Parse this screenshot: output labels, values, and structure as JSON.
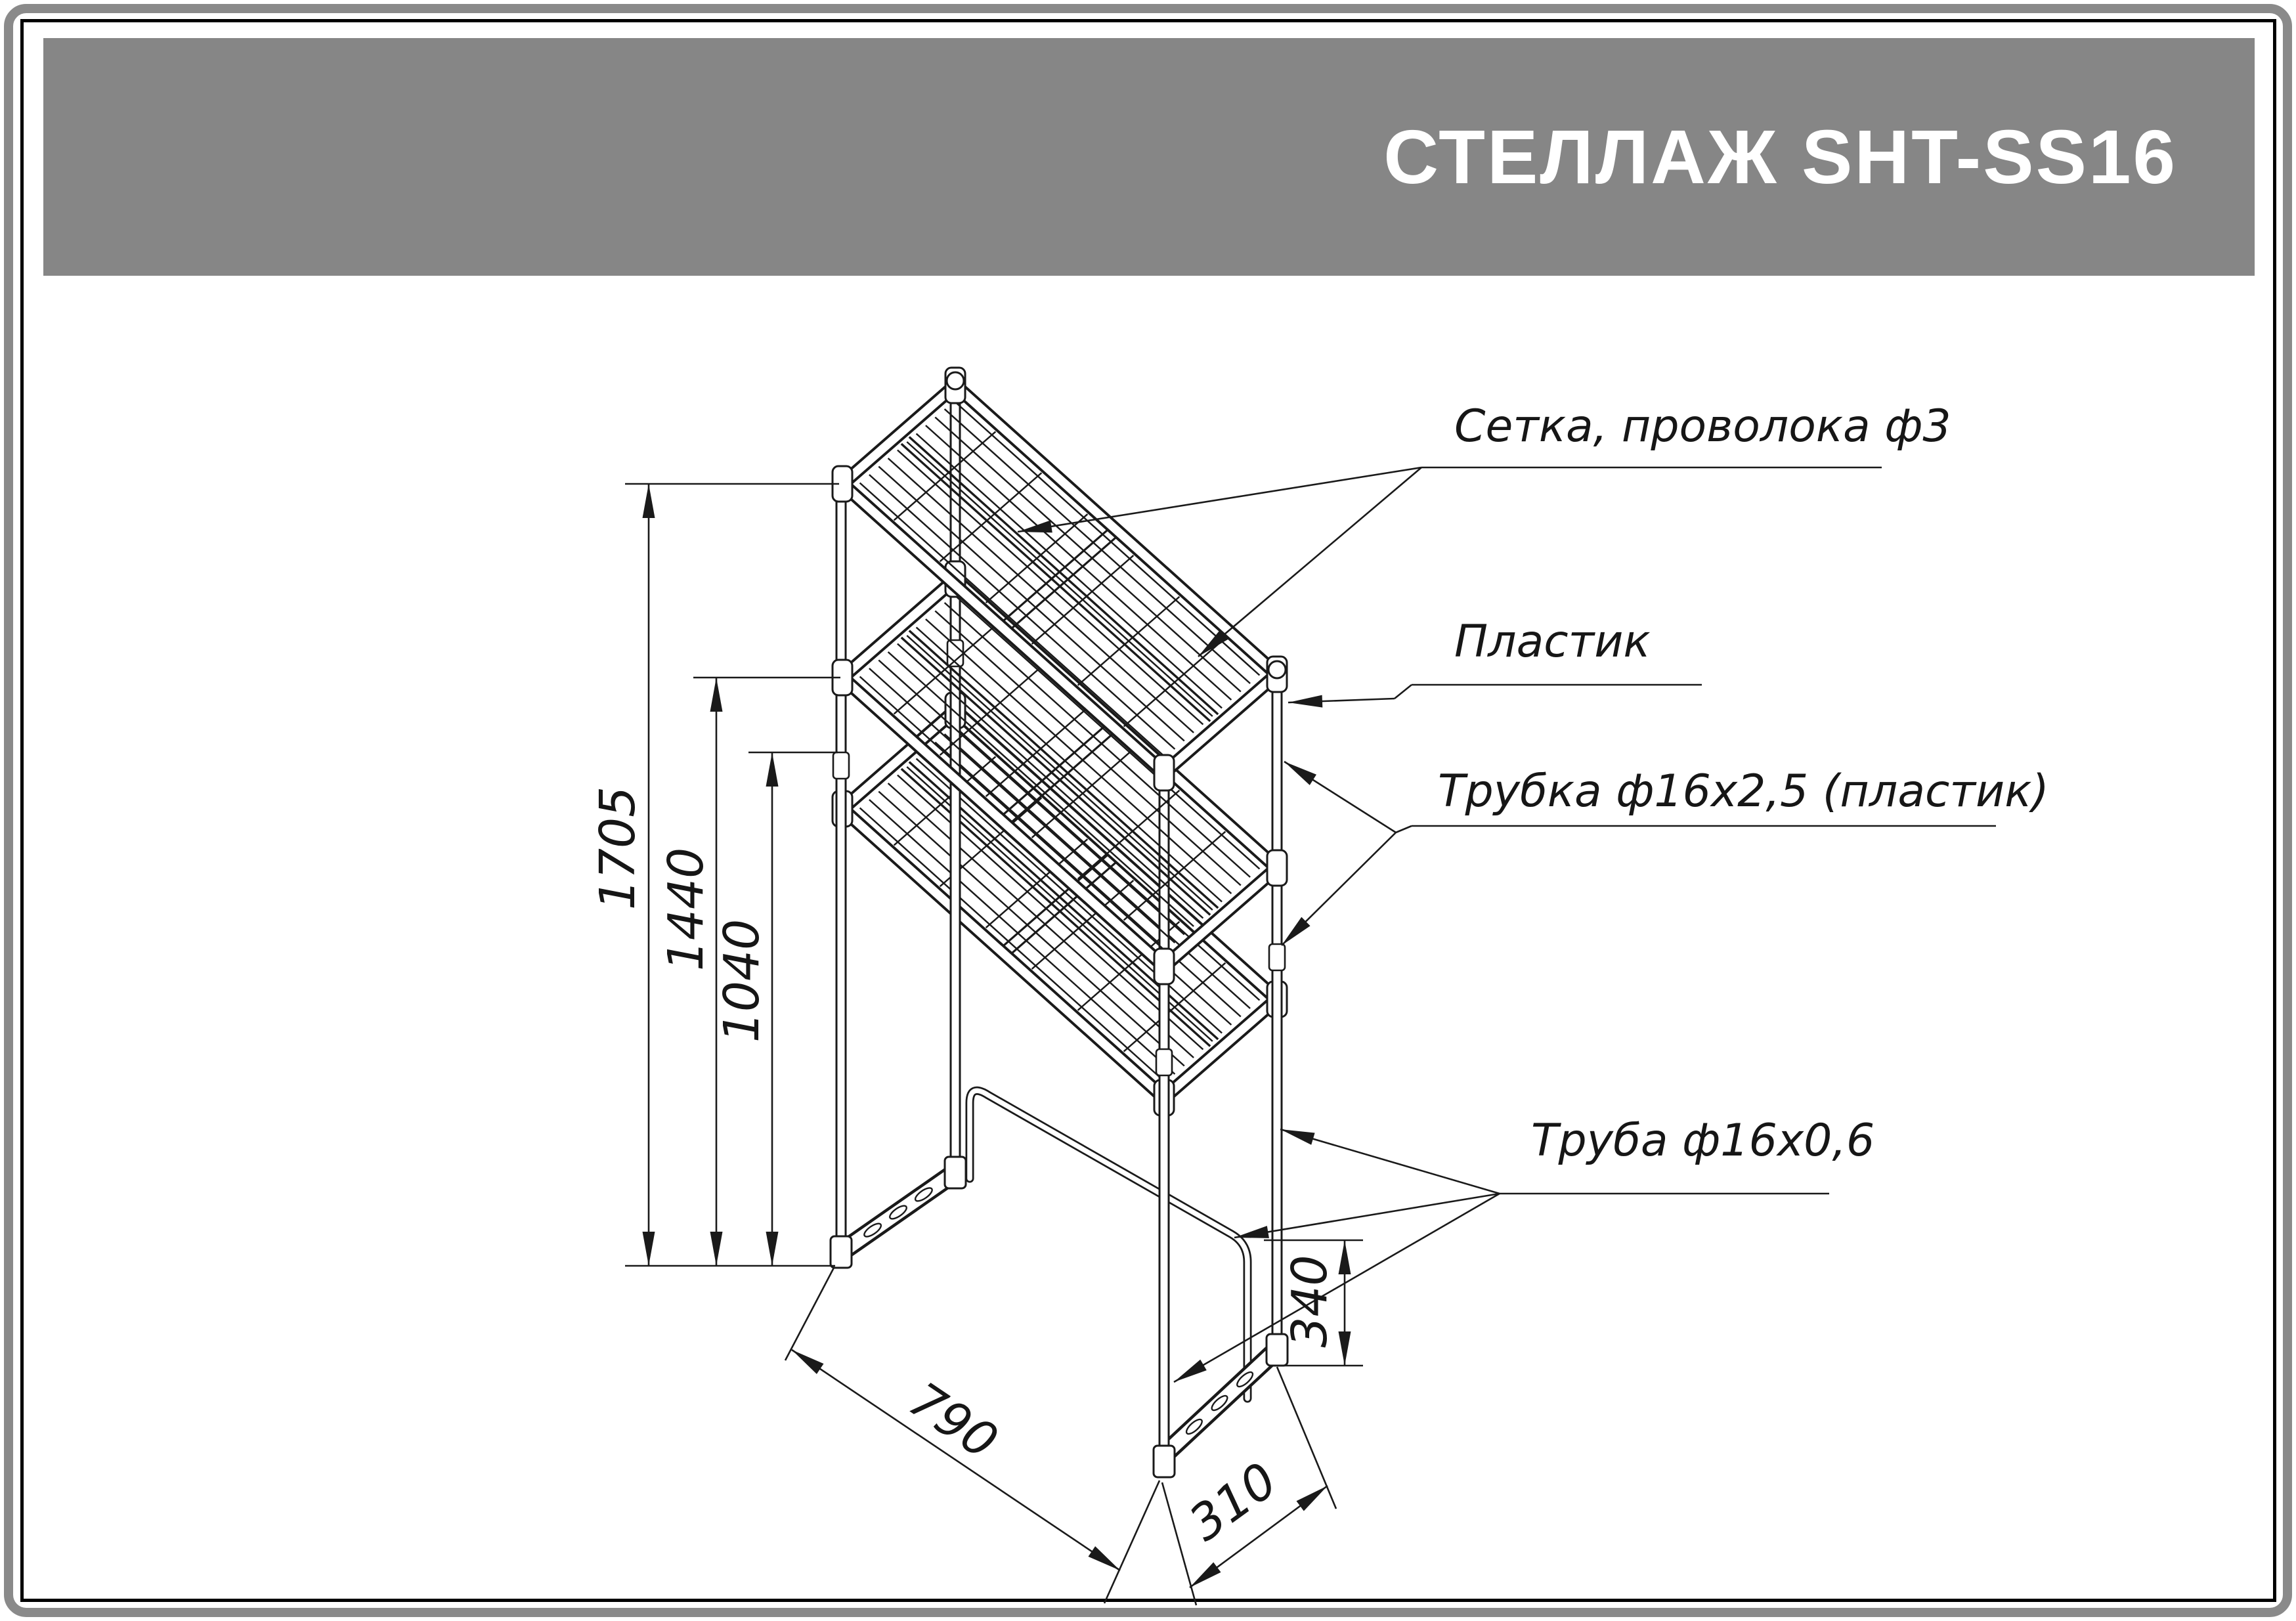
{
  "page": {
    "title": "СТЕЛЛАЖ SHT-SS16",
    "type_note": "furniture assembly technical drawing, isometric view of a 3-shelf rack"
  },
  "annotations": {
    "setka": {
      "text": "Сетка, проволока ф3"
    },
    "plastik": {
      "text": "Пластик"
    },
    "trubka": {
      "text": "Трубка ф16х2,5 (пластик)"
    },
    "truba": {
      "text": "Труба ф16х0,6"
    }
  },
  "dimensions": {
    "height_total": {
      "label": "1705"
    },
    "height_middle": {
      "label": "1440"
    },
    "height_clearance": {
      "label": "1040"
    },
    "width": {
      "label": "790"
    },
    "depth": {
      "label": "310"
    },
    "base_height": {
      "label": "340"
    }
  },
  "colors": {
    "banner": "#868686",
    "frame_outer": "#8a8a8a",
    "frame_inner": "#000000",
    "line": "#1a1a1a",
    "background": "#ffffff",
    "title_text": "#ffffff"
  }
}
